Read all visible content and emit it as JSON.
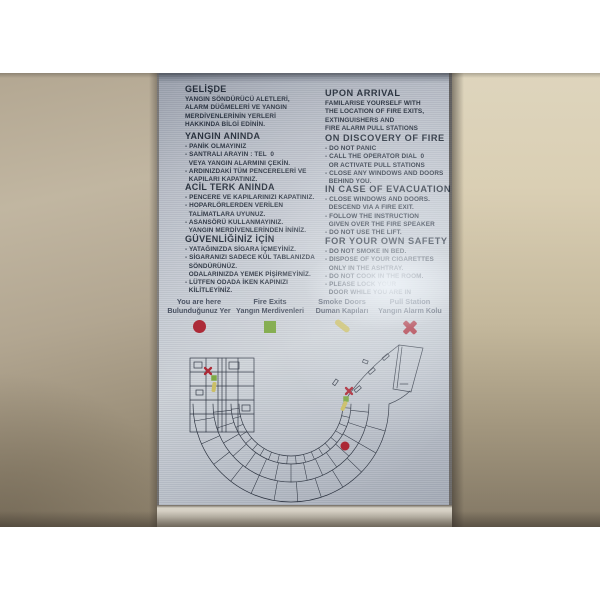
{
  "colors": {
    "red": "#a81f2d",
    "green": "#78a53e",
    "yellow": "#c9bc5f",
    "ink": "#232c3a"
  },
  "sign": {
    "turkish_sections": [
      {
        "heading": "GELİŞDE",
        "lines": [
          "YANGIN SÖNDÜRÜCÜ ALETLERİ,",
          "ALARM DÜĞMELERİ VE YANGIN",
          "MERDİVENLERİNİN YERLERİ",
          "HAKKINDA BİLGİ EDİNİN."
        ]
      },
      {
        "heading": "YANGIN ANINDA",
        "lines": [
          "- PANİK OLMAYINIZ",
          "- SANTRALI ARAYIN : TEL  0",
          "  VEYA YANGIN ALARMINI ÇEKİN.",
          "- ARDINIZDAKİ TÜM PENCERELERİ VE",
          "  KAPILARI KAPATINIZ."
        ]
      },
      {
        "heading": "ACİL TERK ANINDA",
        "lines": [
          "- PENCERE VE KAPILARINIZI KAPATINIZ.",
          "- HOPARLÖRLERDEN VERİLEN",
          "  TALİMATLARA UYUNUZ.",
          "- ASANSÖRÜ KULLANMAYINIZ.",
          "  YANGIN MERDİVENLERİNDEN İNİNİZ."
        ]
      },
      {
        "heading": "GÜVENLİĞİNİZ İÇİN",
        "lines": [
          "- YATAĞINIZDA SİGARA İÇMEYİNİZ.",
          "- SİGARANIZI SADECE KÜL TABLANIZDA",
          "  SÖNDÜRÜNÜZ.",
          "  ODALARINIZDA YEMEK PİŞİRMEYİNİZ.",
          "- LÜTFEN ODADA İKEN KAPINIZI",
          "  KİLİTLEYİNİZ."
        ]
      }
    ],
    "english_sections": [
      {
        "heading": "UPON ARRIVAL",
        "lines": [
          "FAMILARISE YOURSELF WITH",
          "THE LOCATION OF FIRE EXITS,",
          "EXTINGUISHERS AND",
          "FIRE ALARM PULL STATIONS"
        ]
      },
      {
        "heading": "ON DISCOVERY OF FIRE",
        "lines": [
          "- DO NOT PANIC",
          "- CALL THE OPERATOR DIAL  0",
          "  OR ACTIVATE PULL STATIONS",
          "- CLOSE ANY WINDOWS AND DOORS",
          "  BEHIND YOU."
        ]
      },
      {
        "heading": "IN CASE OF EVACUATION",
        "lines": [
          "- CLOSE WINDOWS AND DOORS.",
          "  DESCEND VIA A FIRE EXIT.",
          "- FOLLOW THE INSTRUCTION",
          "  GIVEN OVER THE FIRE SPEAKER",
          "- DO NOT USE THE LIFT."
        ]
      },
      {
        "heading": "FOR YOUR OWN SAFETY",
        "lines": [
          "- DO NOT SMOKE IN BED.",
          "- DISPOSE OF YOUR CIGARETTES",
          "  ONLY IN THE ASHTRAY.",
          "- DO NOT COOK IN THE ROOM.",
          "- PLEASE LOCK YOUR",
          "  DOOR WHILE YOU ARE IN"
        ]
      }
    ],
    "legend": {
      "items": [
        {
          "label_en": "You are here",
          "label_tr": "Bulunduğunuz Yer",
          "symbol": "dot"
        },
        {
          "label_en": "Fire Exits",
          "label_tr": "Yangın Merdivenleri",
          "symbol": "square"
        },
        {
          "label_en": "Smoke Doors",
          "label_tr": "Duman Kapıları",
          "symbol": "bar"
        },
        {
          "label_en": "Pull Station",
          "label_tr": "Yangın Alarm Kolu",
          "symbol": "cross"
        }
      ]
    },
    "map": {
      "markers": [
        {
          "type": "pull-station",
          "x": 206,
          "y": 371
        },
        {
          "type": "fire-exit",
          "x": 212,
          "y": 378
        },
        {
          "type": "smoke-door",
          "x": 212,
          "y": 387,
          "angle": 8
        },
        {
          "type": "pull-station",
          "x": 347,
          "y": 391
        },
        {
          "type": "fire-exit",
          "x": 344,
          "y": 399
        },
        {
          "type": "smoke-door",
          "x": 342,
          "y": 406,
          "angle": 25
        },
        {
          "type": "you-are-here",
          "x": 343,
          "y": 446
        }
      ]
    }
  }
}
